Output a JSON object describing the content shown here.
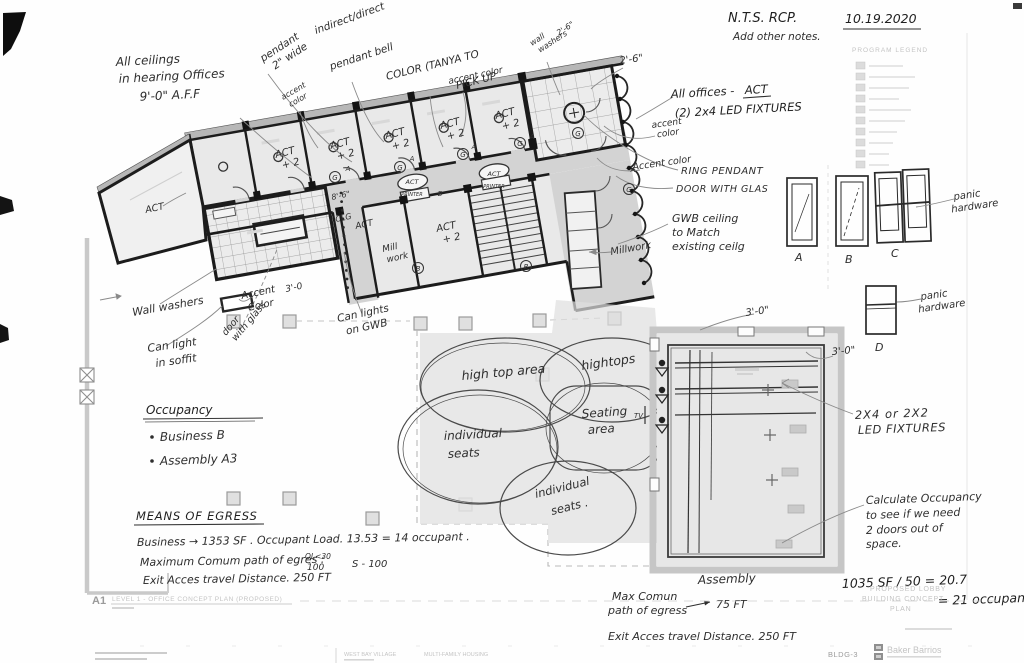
{
  "meta": {
    "nts": "N.T.S.   RCP.",
    "add_notes": "Add other notes.",
    "date": "10.19.2020"
  },
  "legend": {
    "title": "PROGRAM LEGEND"
  },
  "ceiling_note": {
    "l1": "All ceilings",
    "l2": "in hearing Offices",
    "l3": "9'-0\" A.F.F"
  },
  "pendant_notes": {
    "pendant": "pendant",
    "wide": "2\" wide",
    "indirect": "indirect/direct",
    "bell": "pendant bell",
    "color1": "COLOR (TANYA TO",
    "color2": "PICK UP",
    "accent_a": "accent",
    "accent_b": "color",
    "accent": "accent color",
    "wall_a": "wall",
    "wall_b": "washers",
    "dim_small": "2'-6\"",
    "dim_conf": "2'-6\""
  },
  "office_notes": {
    "all_offices": "All offices -",
    "act": "ACT",
    "fixtures": "(2) 2x4 LED FIXTURES",
    "accent1a": "accent",
    "accent1b": "color",
    "accent2": "Accent color",
    "ring": "RING PENDANT",
    "door_glass": "DOOR WITH GLAS",
    "gwb1": "GWB ceiling",
    "gwb2": "to Match",
    "gwb3": "existing ceilg",
    "millwork": "Millwork"
  },
  "plan_labels": {
    "act": "ACT",
    "plus2": "+ 2",
    "printer": "PRINTER",
    "clg1": "8'-6\"",
    "clg2": "CLG",
    "mill1": "Mill",
    "mill2": "work",
    "dim30": "3'-0",
    "tagA": "A",
    "tagB": "B",
    "tagG": "G",
    "tv": "TV"
  },
  "left_notes": {
    "wall_washers": "Wall washers",
    "can1": "Can light",
    "can2": "in soffit",
    "accent1": "Accent",
    "accent2": "Color",
    "door1": "door",
    "door2": "with glass",
    "canlights1": "Can lights",
    "canlights2": "on GWB"
  },
  "doors": {
    "a": "A",
    "b": "B",
    "c": "C",
    "d": "D",
    "panic1a": "panic",
    "panic1b": "hardware",
    "panic2a": "panic",
    "panic2b": "hardware",
    "dim1": "3'-0\"",
    "dim2": "3'-0\"",
    "led1": "2X4  or  2X2",
    "led2": "LED FIXTURES",
    "calc1": "Calculate Occupancy",
    "calc2": "to see if we need",
    "calc3": "2 doors out of",
    "calc4": "space."
  },
  "occupancy": {
    "title": "Occupancy",
    "item1": "Business  B",
    "item2": "Assembly  A3"
  },
  "egress": {
    "title": "MEANS OF EGRESS",
    "l1": "Business  →  1353 SF .  Occupant Load.   13.53 = 14 occupant .",
    "l2a": "Maximum Comum path of egres :",
    "l2sup": "OL<30",
    "l2b": "100",
    "l2c": "S - 100",
    "l3": "Exit Acces travel Distance.    250 FT"
  },
  "seating": {
    "hightop_area": "high top area",
    "hightops": "hightops",
    "seating1": "Seating",
    "seating2": "area",
    "ind1a": "individual",
    "ind1b": "seats",
    "ind2a": "individual",
    "ind2b": "seats ."
  },
  "assembly": {
    "title": "Assembly",
    "l1a": "Max Comun",
    "l1b": "path of egress",
    "l1c": "75 FT",
    "l2": "Exit Acces travel Distance.   250 FT"
  },
  "calc": {
    "line1": "1035 SF / 50 = 20.7",
    "line2": "= 21 occupant"
  },
  "titleblock": {
    "sheet_ref": "A1",
    "title": "LEVEL 1 - OFFICE CONCEPT PLAN (PROPOSED)",
    "print1": "PROPOSED LOBBY",
    "print2": "BUILDING CONCEPT",
    "print3": "PLAN",
    "sheet_no": "BLDG-3",
    "firm": "Baker Barrios",
    "project": "WEST BAY VILLAGE",
    "project2": "MULTI-FAMILY HOUSING"
  }
}
